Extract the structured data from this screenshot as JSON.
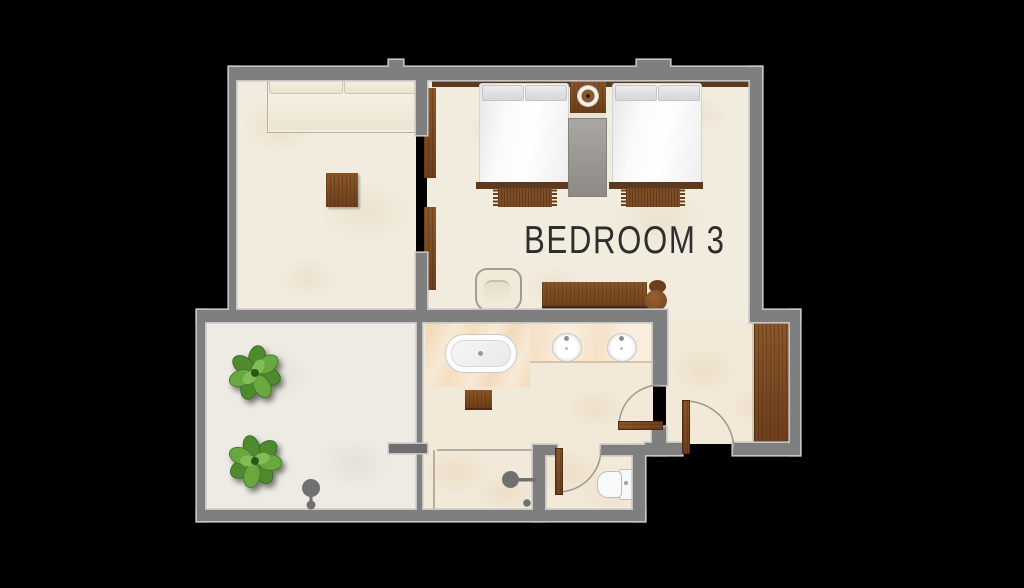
{
  "page": {
    "background": "#000000",
    "type": "architectural floor plan"
  },
  "bedroom": {
    "label": "BEDROOM 3"
  },
  "palette": {
    "wall": "#7f7f7f",
    "wall_outline": "#c6c6c6",
    "floor_cream": "#f2ecdf",
    "floor_terrace": "#edebe4",
    "floor_bath": "#f2e9d9",
    "marble": "#f7ead6",
    "counter": "#f9eedd",
    "wood": "#7d4a24",
    "wood_dark": "#5d3a1d",
    "rug_gray": "#9d9994",
    "plant_green": "#5e9a3c",
    "fixture_gray": "#707070",
    "glass": "#b3afa3",
    "label_text": "#2e2e2e"
  },
  "icons": [
    "twin-bed-icon",
    "twin-bed-icon",
    "nightstand-icon",
    "lamp-icon",
    "runner-rug-icon",
    "bed-rug-icon",
    "bed-rug-icon",
    "daybed-sofa-icon",
    "side-table-icon",
    "armchair-icon",
    "desk-icon",
    "desk-chair-icon",
    "bathtub-icon",
    "sink-icon",
    "sink-icon",
    "vanity-counter-icon",
    "stool-icon",
    "wardrobe-icon",
    "toilet-icon",
    "shower-head-icon",
    "outdoor-shower-icon",
    "plant-icon",
    "plant-icon",
    "door-icon",
    "door-icon",
    "door-icon",
    "sliding-door-icon",
    "glass-screen-icon"
  ]
}
